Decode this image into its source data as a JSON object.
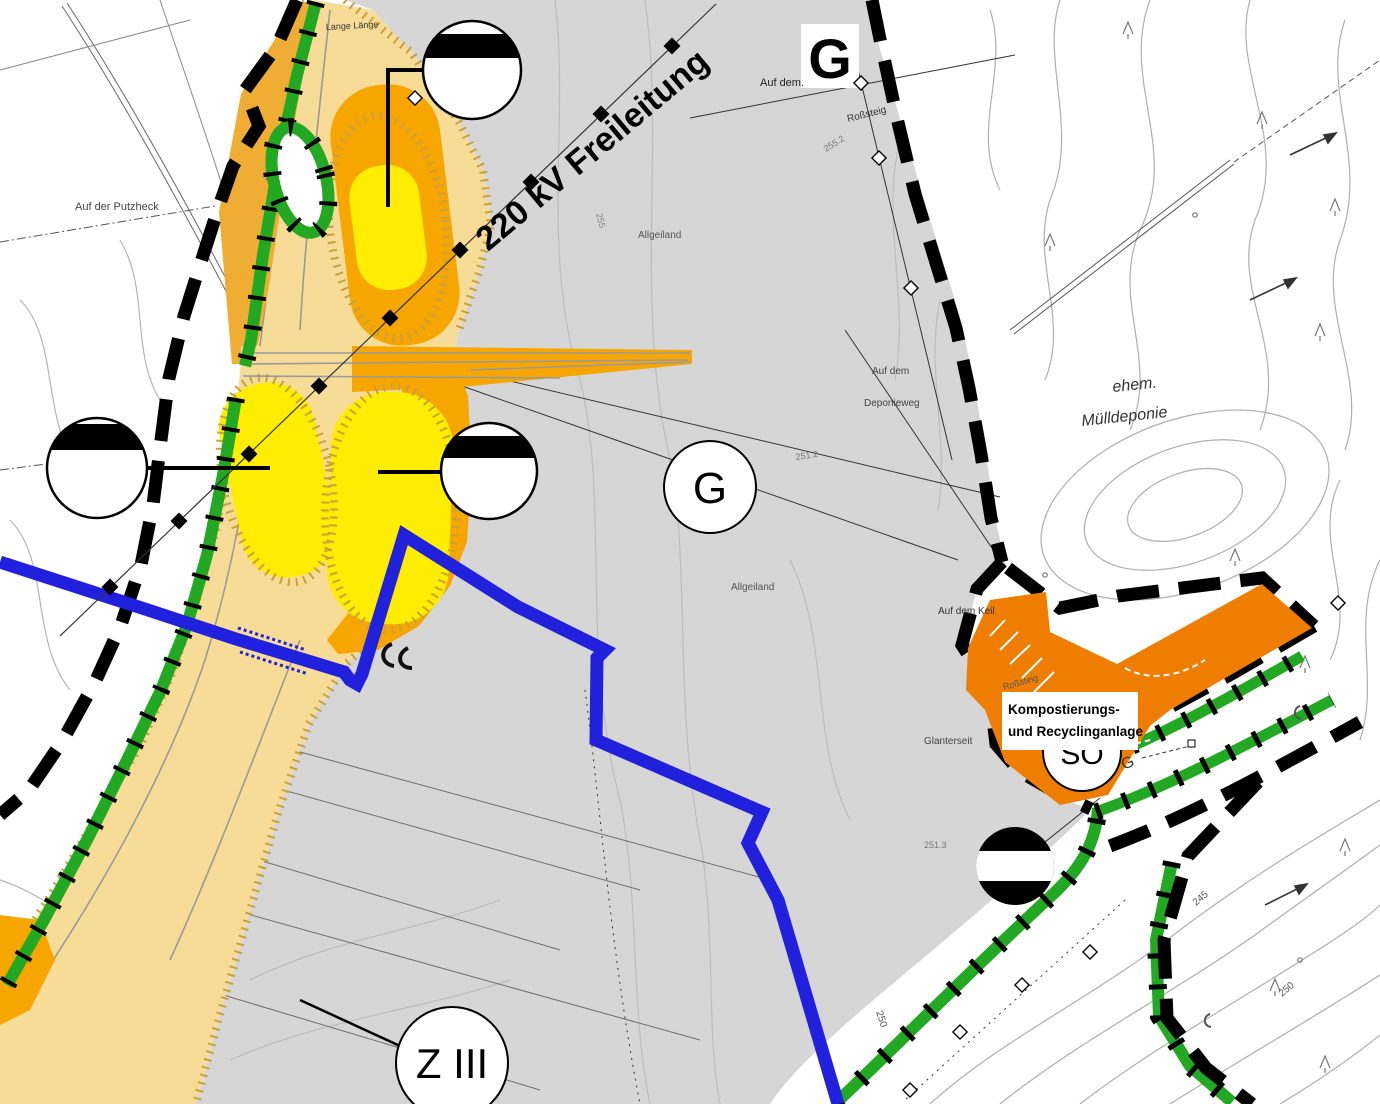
{
  "map": {
    "zones": {
      "g_top": "G",
      "g_main": "G",
      "so": "SO",
      "z3": "Z III",
      "g_strip": "G"
    },
    "labels": {
      "power_line": "220 kV Freileitung",
      "kompost_1": "Kompostierungs-",
      "kompost_2": "und Recyclinganlage",
      "muell_1": "ehem.",
      "muell_2": "Mülldeponie",
      "lange_laenge": "Lange Länge",
      "putzheck": "Auf der Putzheck",
      "auf_dem": "Auf dem.",
      "rosssteig_1": "Roßsteig",
      "rosssteig_2": "Roßsteig",
      "deponieweg_1": "Auf dem",
      "deponieweg_2": "Deponieweg",
      "allgeiland_1": "Allgeiland",
      "allgeiland_2": "Allgeiland",
      "keil": "Auf dem Keil",
      "glanterseit": "Glanterseit"
    },
    "elevations": {
      "e_2552": "255.2",
      "e_2512": "251.2",
      "e_2513": "251.3",
      "e_245": "245",
      "e_250a": "250",
      "e_250b": "250",
      "e_255": "255"
    },
    "colors": {
      "area_gray": "#d6d6d6",
      "road_beige": "#f6dc96",
      "road_hatch": "#c9a23e",
      "yellow": "#ffed00",
      "orange": "#f7a600",
      "amber": "#f0ad33",
      "so_orange": "#ef7d00",
      "green": "#22a822",
      "blue": "#2121dd",
      "contour_gray": "#aeaeae"
    }
  }
}
